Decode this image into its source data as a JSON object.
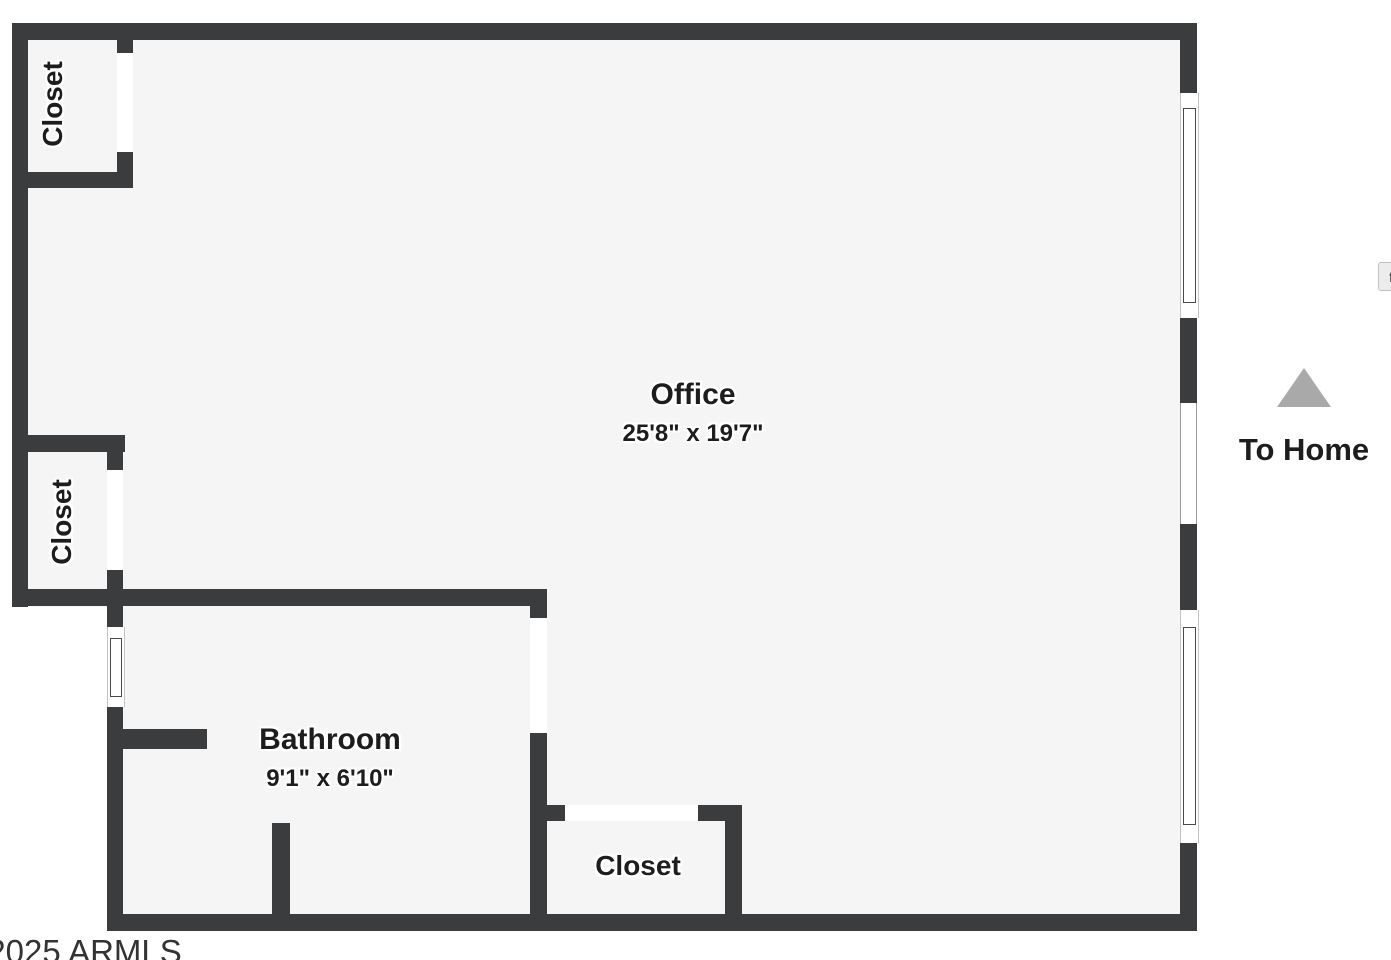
{
  "plan": {
    "rooms": [
      {
        "id": "office",
        "label": "Office",
        "dimensions": "25'8\" x 19'7\""
      },
      {
        "id": "bathroom",
        "label": "Bathroom",
        "dimensions": "9'1\" x 6'10\""
      },
      {
        "id": "closet-top-left",
        "label": "Closet"
      },
      {
        "id": "closet-mid-left",
        "label": "Closet"
      },
      {
        "id": "closet-bottom",
        "label": "Closet"
      }
    ],
    "annotations": [
      {
        "id": "to-home",
        "label": "To Home",
        "icon": "up-triangle-icon"
      }
    ],
    "features": [
      "window-icon",
      "door-opening",
      "open-passage"
    ],
    "colors": {
      "wall": "#3a3c3d",
      "floor": "#f5f5f5",
      "background": "#ffffff",
      "arrow": "#a9a9a9",
      "label_text": "#1d1d1d"
    }
  },
  "footer": {
    "copyright": "©2025 ARMLS"
  },
  "controls": {
    "fullscreen_label": "f"
  }
}
